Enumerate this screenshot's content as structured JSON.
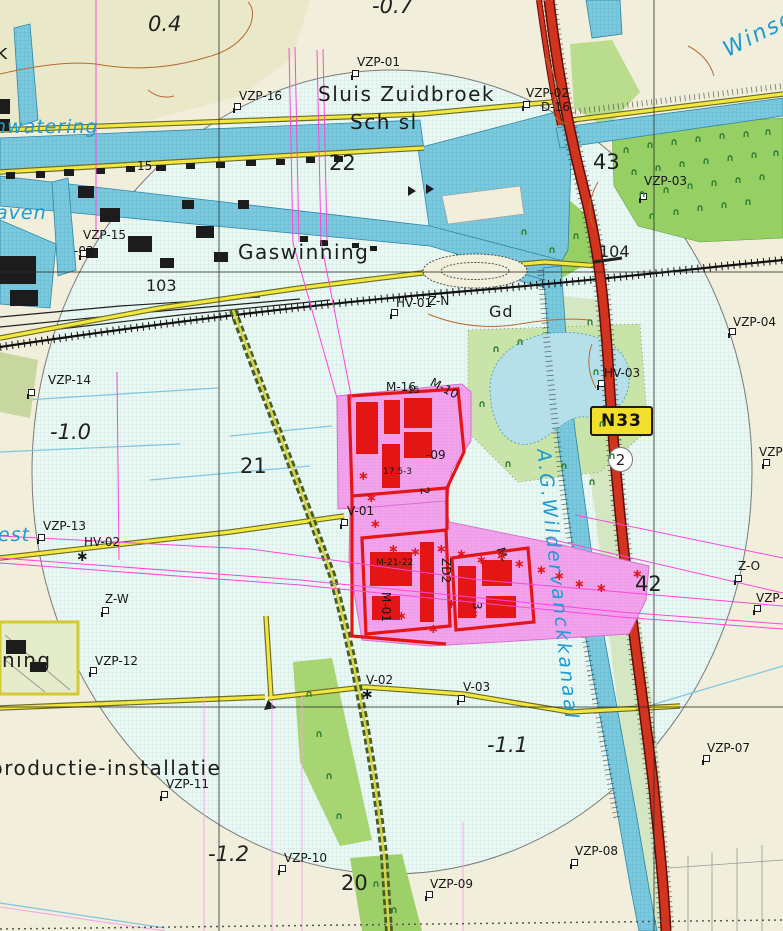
{
  "colors": {
    "land": "#f1eedb",
    "circle_fill": "#edf7f3",
    "circle_grid": "#c6e8e0",
    "water": "#7cc9dd",
    "water_edge": "#2e86a8",
    "water_label": "#1d9bd4",
    "green_trees": "#96cf63",
    "green_pale": "#d4e7c2",
    "green_mid": "#b9dc8d",
    "road_yellow": "#f2e73c",
    "highway_red": "#d23420",
    "pink_zone": "#f3a4ec",
    "building_red": "#e31515",
    "pipeline_magenta": "#ff46da",
    "contour_orange": "#b86a32",
    "shield_yellow": "#f2df2b"
  },
  "shield": {
    "label": "N33"
  },
  "road_marker": {
    "label": "2"
  },
  "labels": [
    {
      "t": "Sluis Zuidbroek",
      "x": 318,
      "y": 84,
      "c": "place"
    },
    {
      "t": "Sch sl",
      "x": 350,
      "y": 112,
      "c": "place"
    },
    {
      "t": "Gaswinning",
      "x": 238,
      "y": 242,
      "c": "place"
    },
    {
      "t": "Gd",
      "x": 489,
      "y": 304,
      "c": "place-sm"
    },
    {
      "t": "productie-installatie",
      "x": -10,
      "y": 758,
      "c": "place"
    },
    {
      "t": "ning",
      "x": 2,
      "y": 650,
      "c": "place"
    },
    {
      "t": "k",
      "x": -4,
      "y": 42,
      "c": "place"
    },
    {
      "t": "nwatering",
      "x": -6,
      "y": 118,
      "c": "water"
    },
    {
      "t": "aven",
      "x": -4,
      "y": 204,
      "c": "water"
    },
    {
      "t": "est",
      "x": -2,
      "y": 526,
      "c": "water"
    },
    {
      "t": "Winschoterdiep",
      "x": 720,
      "y": 42,
      "c": "water-lg",
      "r": -27
    },
    {
      "t": "A.G.Wildervanckkanaal",
      "x": 552,
      "y": 448,
      "c": "water-vert",
      "r": 84
    },
    {
      "t": "0.4",
      "x": 148,
      "y": 14,
      "c": "elev"
    },
    {
      "t": "-0.7",
      "x": 372,
      "y": -4,
      "c": "elev"
    },
    {
      "t": "-1.0",
      "x": 50,
      "y": 422,
      "c": "elev"
    },
    {
      "t": "-1.1",
      "x": 487,
      "y": 735,
      "c": "elev"
    },
    {
      "t": "-1.2",
      "x": 208,
      "y": 844,
      "c": "elev"
    },
    {
      "t": "20",
      "x": 341,
      "y": 873,
      "c": "num"
    },
    {
      "t": "21",
      "x": 240,
      "y": 456,
      "c": "num"
    },
    {
      "t": "22",
      "x": 329,
      "y": 153,
      "c": "num"
    },
    {
      "t": "42",
      "x": 635,
      "y": 574,
      "c": "num"
    },
    {
      "t": "43",
      "x": 593,
      "y": 152,
      "c": "num"
    },
    {
      "t": "103",
      "x": 146,
      "y": 278,
      "c": "num-sm"
    },
    {
      "t": "104",
      "x": 599,
      "y": 244,
      "c": "num-sm"
    },
    {
      "t": "VZP-01",
      "x": 357,
      "y": 56,
      "c": "point"
    },
    {
      "t": "VZP-02",
      "x": 526,
      "y": 87,
      "c": "point"
    },
    {
      "t": "D-16",
      "x": 541,
      "y": 101,
      "c": "point"
    },
    {
      "t": "VZP-03",
      "x": 644,
      "y": 175,
      "c": "point"
    },
    {
      "t": "VZP-04",
      "x": 733,
      "y": 316,
      "c": "point"
    },
    {
      "t": "VZP-0",
      "x": 759,
      "y": 446,
      "c": "point"
    },
    {
      "t": "Z-O",
      "x": 738,
      "y": 560,
      "c": "point"
    },
    {
      "t": "VZP-0",
      "x": 756,
      "y": 592,
      "c": "point"
    },
    {
      "t": "VZP-07",
      "x": 707,
      "y": 742,
      "c": "point"
    },
    {
      "t": "VZP-08",
      "x": 575,
      "y": 845,
      "c": "point"
    },
    {
      "t": "VZP-09",
      "x": 430,
      "y": 878,
      "c": "point"
    },
    {
      "t": "VZP-10",
      "x": 284,
      "y": 852,
      "c": "point"
    },
    {
      "t": "VZP-11",
      "x": 166,
      "y": 778,
      "c": "point"
    },
    {
      "t": "VZP-12",
      "x": 95,
      "y": 655,
      "c": "point"
    },
    {
      "t": "VZP-13",
      "x": 43,
      "y": 520,
      "c": "point"
    },
    {
      "t": "VZP-14",
      "x": 48,
      "y": 374,
      "c": "point"
    },
    {
      "t": "VZP-15",
      "x": 83,
      "y": 229,
      "c": "point"
    },
    {
      "t": "-03",
      "x": 74,
      "y": 245,
      "c": "point"
    },
    {
      "t": "VZP-16",
      "x": 239,
      "y": 90,
      "c": "point"
    },
    {
      "t": "HV-01",
      "x": 396,
      "y": 297,
      "c": "point"
    },
    {
      "t": "Z-N",
      "x": 428,
      "y": 295,
      "c": "point"
    },
    {
      "t": "HV-02",
      "x": 84,
      "y": 536,
      "c": "point"
    },
    {
      "t": "HV-03",
      "x": 604,
      "y": 367,
      "c": "point"
    },
    {
      "t": "V-01",
      "x": 347,
      "y": 505,
      "c": "point"
    },
    {
      "t": "V-02",
      "x": 366,
      "y": 674,
      "c": "point"
    },
    {
      "t": "V-03",
      "x": 463,
      "y": 681,
      "c": "point"
    },
    {
      "t": "Z-W",
      "x": 105,
      "y": 593,
      "c": "point"
    },
    {
      "t": "15",
      "x": 137,
      "y": 160,
      "c": "point"
    },
    {
      "t": "M-16",
      "x": 386,
      "y": 381,
      "c": "point"
    },
    {
      "t": "25",
      "x": 408,
      "y": 387,
      "c": "tiny"
    },
    {
      "t": "M-10",
      "x": 434,
      "y": 376,
      "c": "point",
      "r": 28
    },
    {
      "t": "-09",
      "x": 426,
      "y": 449,
      "c": "point"
    },
    {
      "t": "17.5-3",
      "x": 383,
      "y": 468,
      "c": "tiny"
    },
    {
      "t": "M-21-22",
      "x": 376,
      "y": 559,
      "c": "tiny"
    },
    {
      "t": "ZD2",
      "x": 452,
      "y": 558,
      "c": "point",
      "r": 90
    },
    {
      "t": "M-",
      "x": 506,
      "y": 546,
      "c": "point",
      "r": 75
    },
    {
      "t": "M-01",
      "x": 392,
      "y": 592,
      "c": "point",
      "r": 90
    },
    {
      "t": "3",
      "x": 483,
      "y": 602,
      "c": "point",
      "r": 90
    },
    {
      "t": "2",
      "x": 430,
      "y": 486,
      "c": "point",
      "r": 80
    }
  ],
  "markers": {
    "flags": [
      [
        352,
        70
      ],
      [
        523,
        101
      ],
      [
        640,
        193
      ],
      [
        729,
        328
      ],
      [
        763,
        459
      ],
      [
        735,
        575
      ],
      [
        754,
        605
      ],
      [
        703,
        755
      ],
      [
        571,
        859
      ],
      [
        426,
        891
      ],
      [
        279,
        865
      ],
      [
        161,
        791
      ],
      [
        90,
        667
      ],
      [
        38,
        534
      ],
      [
        28,
        389
      ],
      [
        80,
        250
      ],
      [
        234,
        103
      ],
      [
        598,
        380
      ],
      [
        102,
        607
      ],
      [
        341,
        519
      ],
      [
        458,
        695
      ],
      [
        391,
        309
      ]
    ],
    "stars": [
      [
        76,
        549
      ],
      [
        361,
        687
      ]
    ]
  },
  "vegetation": {
    "green": [
      [
        622,
        146
      ],
      [
        646,
        141
      ],
      [
        670,
        138
      ],
      [
        694,
        135
      ],
      [
        718,
        132
      ],
      [
        742,
        130
      ],
      [
        764,
        128
      ],
      [
        630,
        168
      ],
      [
        654,
        164
      ],
      [
        678,
        160
      ],
      [
        702,
        157
      ],
      [
        726,
        154
      ],
      [
        750,
        151
      ],
      [
        772,
        149
      ],
      [
        638,
        190
      ],
      [
        662,
        186
      ],
      [
        686,
        182
      ],
      [
        710,
        179
      ],
      [
        734,
        176
      ],
      [
        758,
        173
      ],
      [
        648,
        212
      ],
      [
        672,
        208
      ],
      [
        696,
        204
      ],
      [
        720,
        201
      ],
      [
        744,
        198
      ],
      [
        492,
        345
      ],
      [
        516,
        338
      ],
      [
        478,
        400
      ],
      [
        504,
        460
      ],
      [
        560,
        462
      ],
      [
        608,
        452
      ],
      [
        586,
        318
      ],
      [
        592,
        368
      ],
      [
        598,
        420
      ],
      [
        588,
        478
      ],
      [
        305,
        690
      ],
      [
        315,
        730
      ],
      [
        325,
        772
      ],
      [
        335,
        812
      ],
      [
        372,
        880
      ],
      [
        390,
        906
      ],
      [
        520,
        228
      ],
      [
        548,
        246
      ],
      [
        572,
        232
      ]
    ],
    "red": [
      [
        360,
        440
      ],
      [
        358,
        470
      ],
      [
        366,
        492
      ],
      [
        370,
        518
      ],
      [
        388,
        543
      ],
      [
        410,
        546
      ],
      [
        436,
        543
      ],
      [
        456,
        548
      ],
      [
        476,
        554
      ],
      [
        496,
        550
      ],
      [
        514,
        558
      ],
      [
        536,
        564
      ],
      [
        554,
        570
      ],
      [
        574,
        578
      ],
      [
        596,
        582
      ],
      [
        632,
        568
      ],
      [
        446,
        598
      ],
      [
        468,
        608
      ],
      [
        428,
        623
      ],
      [
        396,
        610
      ],
      [
        370,
        598
      ]
    ]
  }
}
